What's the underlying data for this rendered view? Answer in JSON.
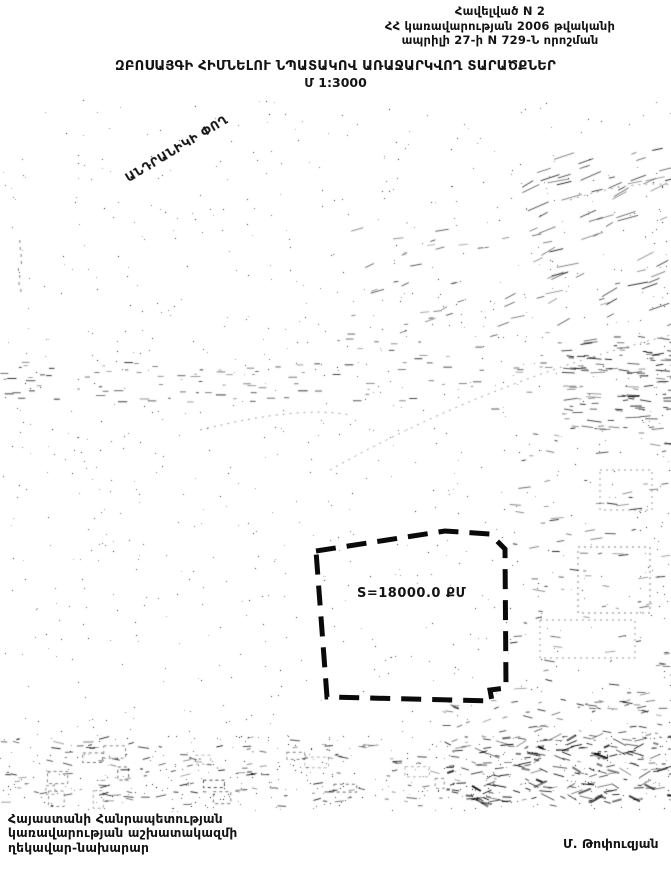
{
  "header": {
    "line1": "Հավելված N 2",
    "line2": "ՀՀ կառավարության 2006 թվականի",
    "line3": "ապրիլի 27-ի N 729-Ն որոշման"
  },
  "title": {
    "main": "ԶԲՈՍԱՅԳԻ ՀԻՄՆԵԼՈՒ ՆՊԱՏԱԿՈՎ ԱՌԱՋԱՐԿՎՈՂ ՏԱՐԱԾՔՆԵՐ",
    "scale": "Մ 1:3000"
  },
  "map": {
    "street_label": "ԱՆԴՐԱՆԻԿԻ ՓՈՂ",
    "parcel": {
      "area_label": "S=18000.0 ՔՄ",
      "outline_points": "316,551 445,531 490,534 505,549 506,688 490,690 492,701 327,697",
      "outline_color": "#0a0a0a"
    }
  },
  "footer": {
    "agency_line1": "Հայաստանի Հանրապետության",
    "agency_line2": "կառավարության աշխատակազմի",
    "agency_line3": "ղեկավար-նախարար",
    "signature": "Մ. Թոփուզյան"
  },
  "colors": {
    "ink": "#141414",
    "paper": "#ffffff"
  }
}
